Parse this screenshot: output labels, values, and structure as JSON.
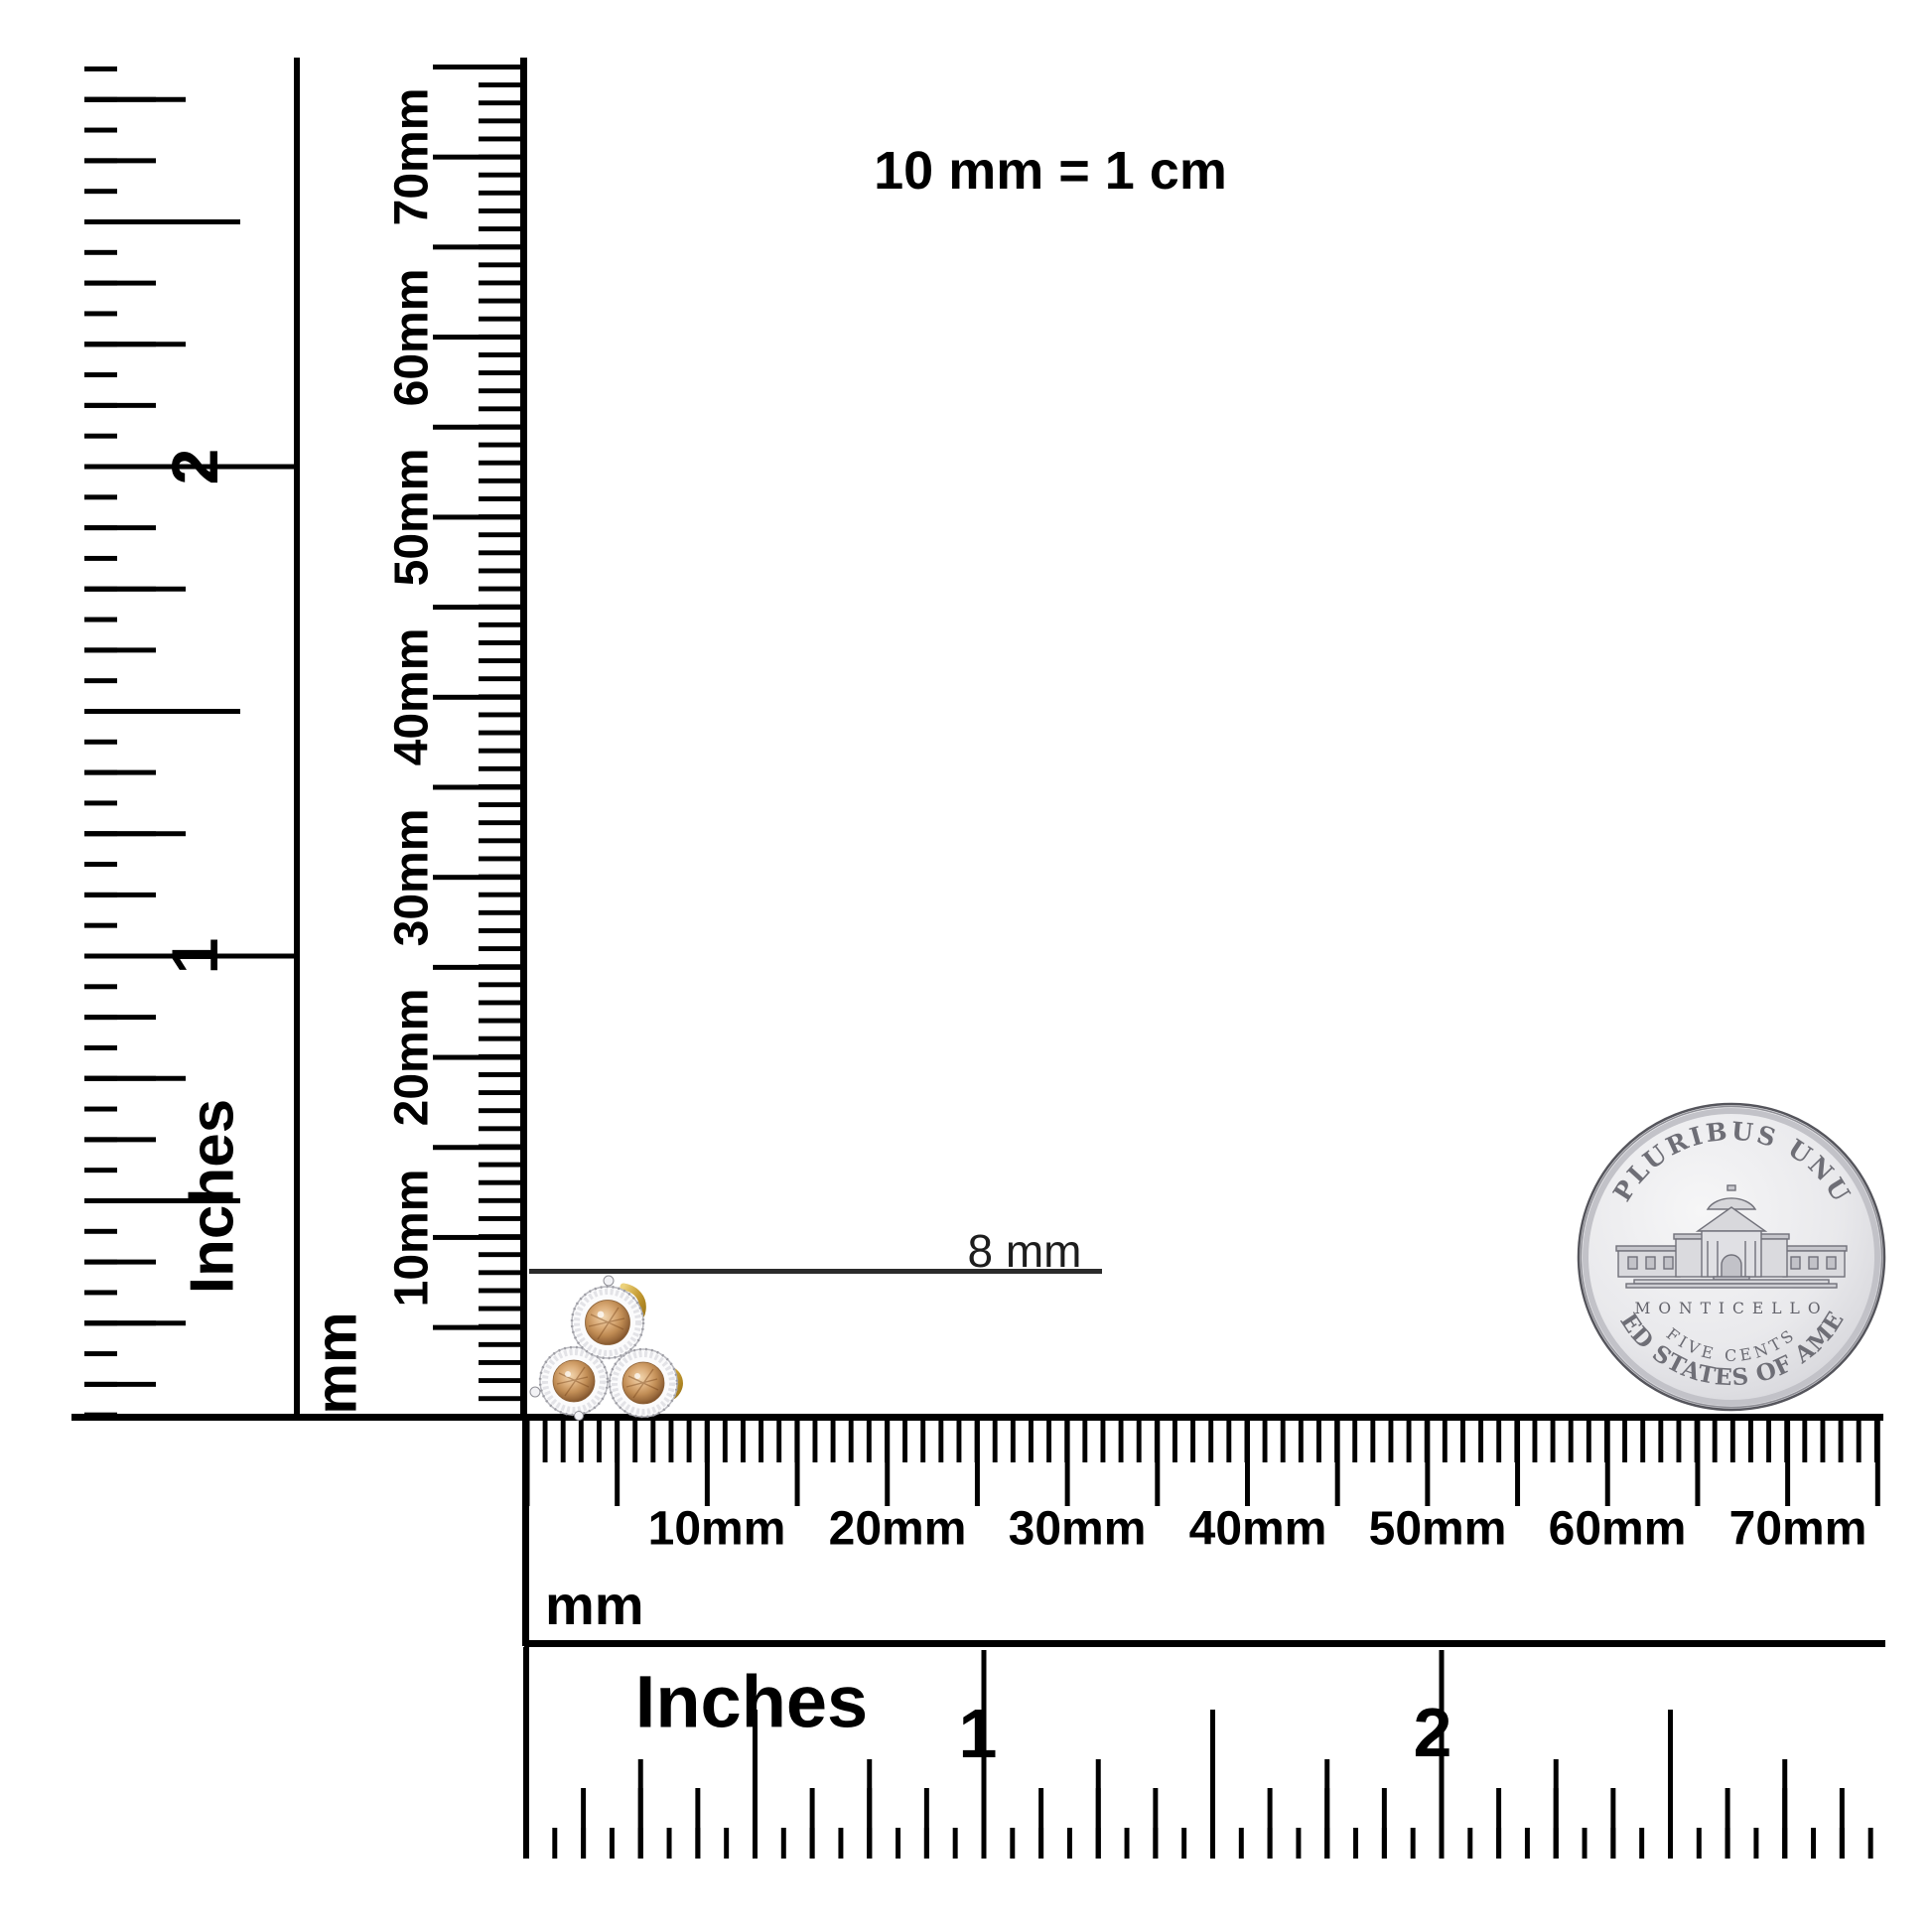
{
  "title": "10 mm = 1 cm",
  "measurement": {
    "label": "8 mm"
  },
  "rulers": {
    "vertical_inches": {
      "unit": "Inches",
      "numbers": [
        "1",
        "2"
      ]
    },
    "vertical_mm": {
      "unit": "mm",
      "labels": [
        "10mm",
        "20mm",
        "30mm",
        "40mm",
        "50mm",
        "60mm",
        "70mm"
      ]
    },
    "horizontal_mm": {
      "unit": "mm",
      "labels": [
        "10mm",
        "20mm",
        "30mm",
        "40mm",
        "50mm",
        "60mm",
        "70mm"
      ]
    },
    "horizontal_inches": {
      "unit": "Inches",
      "numbers": [
        "1",
        "2"
      ]
    }
  },
  "coin": {
    "legend_top": "E PLURIBUS UNUM",
    "building_label": "MONTICELLO",
    "denomination": "FIVE CENTS",
    "legend_bottom": "UNITED STATES OF AMERICA"
  },
  "jewelry": {
    "stones": 3,
    "stone_color": "#cd9a66",
    "halo_color": "#fbfbfc",
    "gold_color": "#c59b33"
  },
  "colors": {
    "background": "#ffffff",
    "ruler_ink": "#000000",
    "annotation_ink": "#1d1d1d",
    "coin_silver": "#e4e4e8",
    "coin_text": "#6e6e76"
  }
}
